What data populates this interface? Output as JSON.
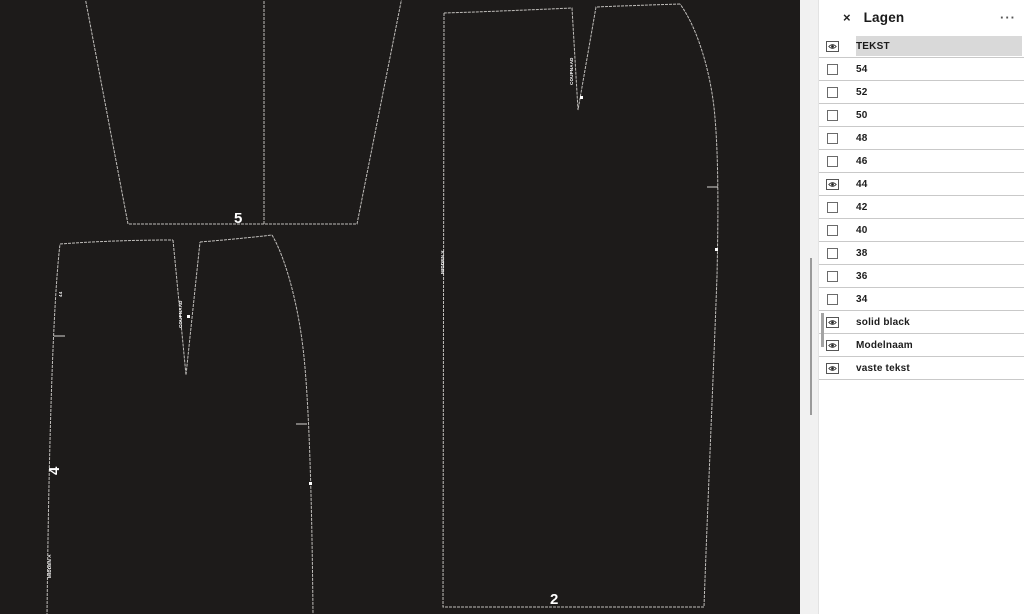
{
  "panel": {
    "title": "Lagen",
    "close_label": "×",
    "menu_label": "···",
    "layers": [
      {
        "label": "TEKST",
        "icon": "eye",
        "selected": true
      },
      {
        "label": "54",
        "icon": "checkbox",
        "selected": false
      },
      {
        "label": "52",
        "icon": "checkbox",
        "selected": false
      },
      {
        "label": "50",
        "icon": "checkbox",
        "selected": false
      },
      {
        "label": "48",
        "icon": "checkbox",
        "selected": false
      },
      {
        "label": "46",
        "icon": "checkbox",
        "selected": false
      },
      {
        "label": "44",
        "icon": "eye",
        "selected": false
      },
      {
        "label": "42",
        "icon": "checkbox",
        "selected": false
      },
      {
        "label": "40",
        "icon": "checkbox",
        "selected": false
      },
      {
        "label": "38",
        "icon": "checkbox",
        "selected": false
      },
      {
        "label": "36",
        "icon": "checkbox",
        "selected": false
      },
      {
        "label": "34",
        "icon": "checkbox",
        "selected": false
      },
      {
        "label": "solid black",
        "icon": "eye",
        "selected": false
      },
      {
        "label": "Modelnaam",
        "icon": "eye",
        "selected": false
      },
      {
        "label": "vaste tekst",
        "icon": "eye",
        "selected": false
      }
    ]
  },
  "canvas": {
    "background": "#1d1b1a",
    "outline_color": "#c9c7c4",
    "pieces": [
      {
        "label": "5"
      },
      {
        "label": "4",
        "edge_text_top": "44",
        "dart_text": "COUPNAAD",
        "edge_text_bottom": "MIDDEN A"
      },
      {
        "label": "2",
        "edge_text": "MIDDEN V",
        "dart_text": "COUPNAAD"
      }
    ]
  }
}
